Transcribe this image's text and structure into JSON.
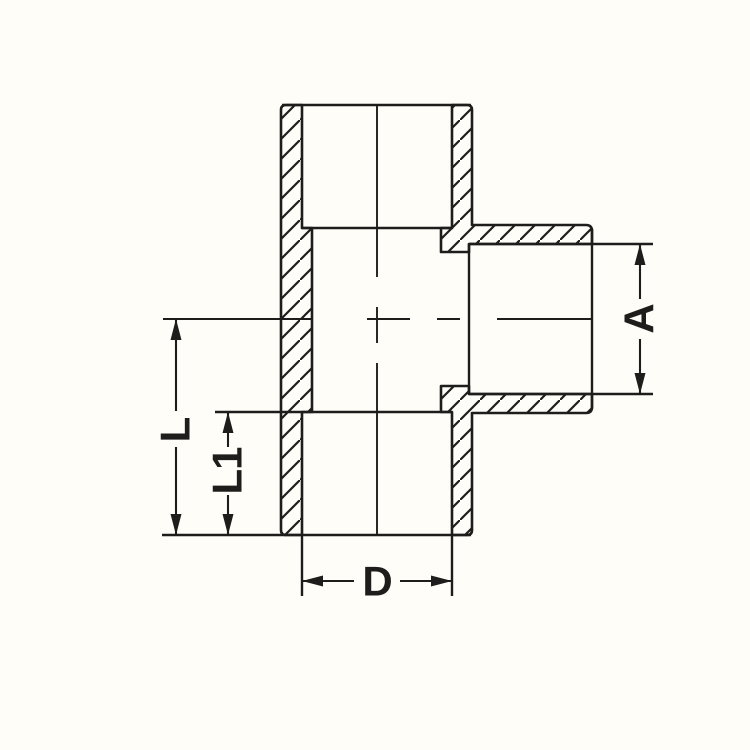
{
  "drawing": {
    "dimensions": {
      "overall_length_label": "L",
      "socket_depth_label": "L1",
      "branch_socket_bore_label": "A",
      "socket_diameter_label": "D"
    },
    "colors": {
      "background": "#fffdf8",
      "line": "#1e1d1b"
    }
  }
}
